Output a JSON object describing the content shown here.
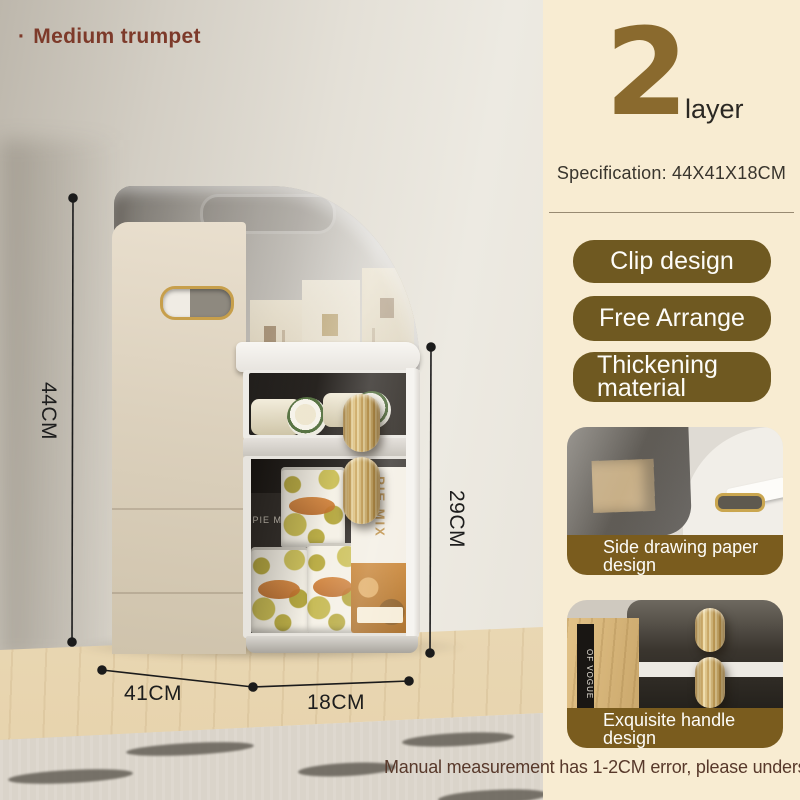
{
  "header": {
    "bullet": "·",
    "title": "Medium trumpet"
  },
  "panel": {
    "layer_count": "2",
    "layer_unit": "layer",
    "specification": "Specification: 44X41X18CM",
    "features": [
      {
        "label": "Clip design"
      },
      {
        "label": "Free Arrange"
      },
      {
        "label": "Thickening material"
      }
    ],
    "cards": [
      {
        "caption": "Side drawing paper design"
      },
      {
        "caption": "Exquisite handle design"
      }
    ]
  },
  "dimensions": {
    "total_height": "44CM",
    "front_height": "29CM",
    "depth": "41CM",
    "width": "18CM"
  },
  "disclaimer": "Manual measurement has 1-2CM error, please understand!",
  "photo_text": {
    "pie_box_label": "PIE MIX",
    "pie_box_label_back": "PIE MI",
    "book_spine": "OF VOGUE"
  },
  "colors": {
    "panel_bg": "#f8ecd2",
    "feature_badge": "#6f5921",
    "caption_band": "#7a5c1e",
    "layer_number": "#8a6a2e",
    "title_text": "#7d3a2a",
    "disclaimer_text": "#58392b",
    "dimension_ink": "#1c1c1c",
    "handle_gold": "#d9bd7e"
  }
}
